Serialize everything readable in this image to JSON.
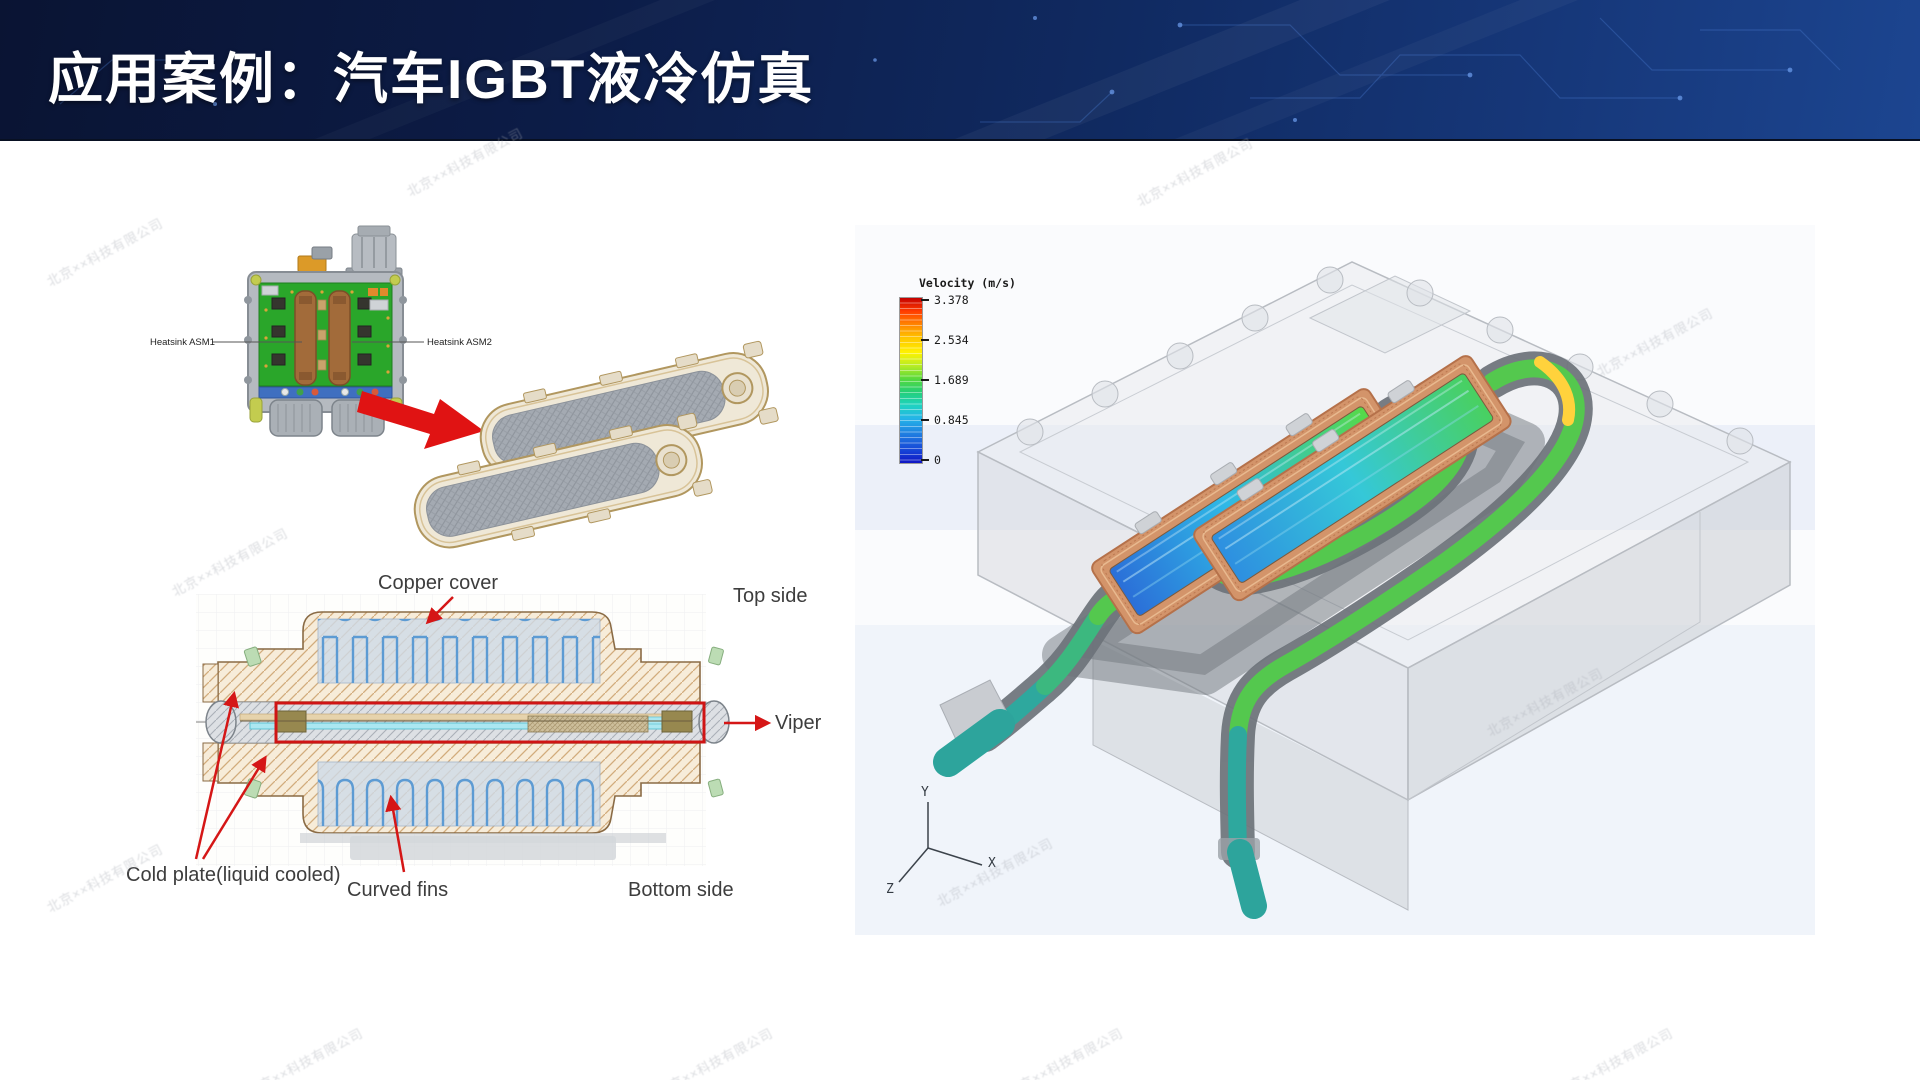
{
  "header": {
    "title": "应用案例：汽车IGBT液冷仿真"
  },
  "module_figure": {
    "heatsink_asm1": "Heatsink ASM1",
    "heatsink_asm2": "Heatsink ASM2"
  },
  "cross_section": {
    "copper_cover": "Copper cover",
    "top_side": "Top side",
    "viper": "Viper",
    "cold_plate": "Cold plate(liquid cooled)",
    "curved_fins": "Curved fins",
    "bottom_side": "Bottom side"
  },
  "cfd": {
    "legend_title": "Velocity (m/s)",
    "legend_ticks": [
      "3.378",
      "2.534",
      "1.689",
      "0.845",
      "0"
    ],
    "axis": {
      "x": "X",
      "y": "Y",
      "z": "Z"
    }
  },
  "watermark_text": "北京××科技有限公司",
  "colors": {
    "banner_dark": "#0a1433",
    "banner_light": "#1c4590",
    "accent_red": "#d51616",
    "pcb_green": "#2aa62a",
    "copper": "#a26b3a",
    "legend_max_color": "#c40000",
    "legend_min_color": "#1016c4"
  }
}
